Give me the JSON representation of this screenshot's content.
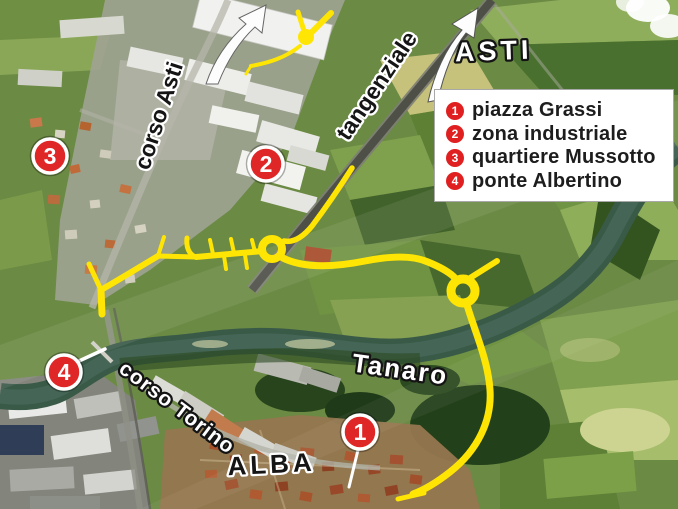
{
  "map": {
    "region_labels": {
      "corso_asti": "corso Asti",
      "tangenziale": "tangenziale",
      "asti_direction": "ASTI",
      "tanaro_river": "Tanaro",
      "corso_torino": "corso Torino",
      "alba_city": "ALBA"
    },
    "markers": [
      {
        "number": "1",
        "place": "piazza Grassi"
      },
      {
        "number": "2",
        "place": "zona industriale"
      },
      {
        "number": "3",
        "place": "quartiere Mussotto"
      },
      {
        "number": "4",
        "place": "ponte Albertino"
      }
    ],
    "colors": {
      "highlighted_route": "#ffe504",
      "marker_red": "#df2727",
      "river_green": "#3a5a48",
      "legend_background": "#ffffff"
    }
  },
  "legend": {
    "items": [
      {
        "number": "1",
        "label": "piazza Grassi"
      },
      {
        "number": "2",
        "label": "zona industriale"
      },
      {
        "number": "3",
        "label": "quartiere Mussotto"
      },
      {
        "number": "4",
        "label": "ponte Albertino"
      }
    ]
  }
}
